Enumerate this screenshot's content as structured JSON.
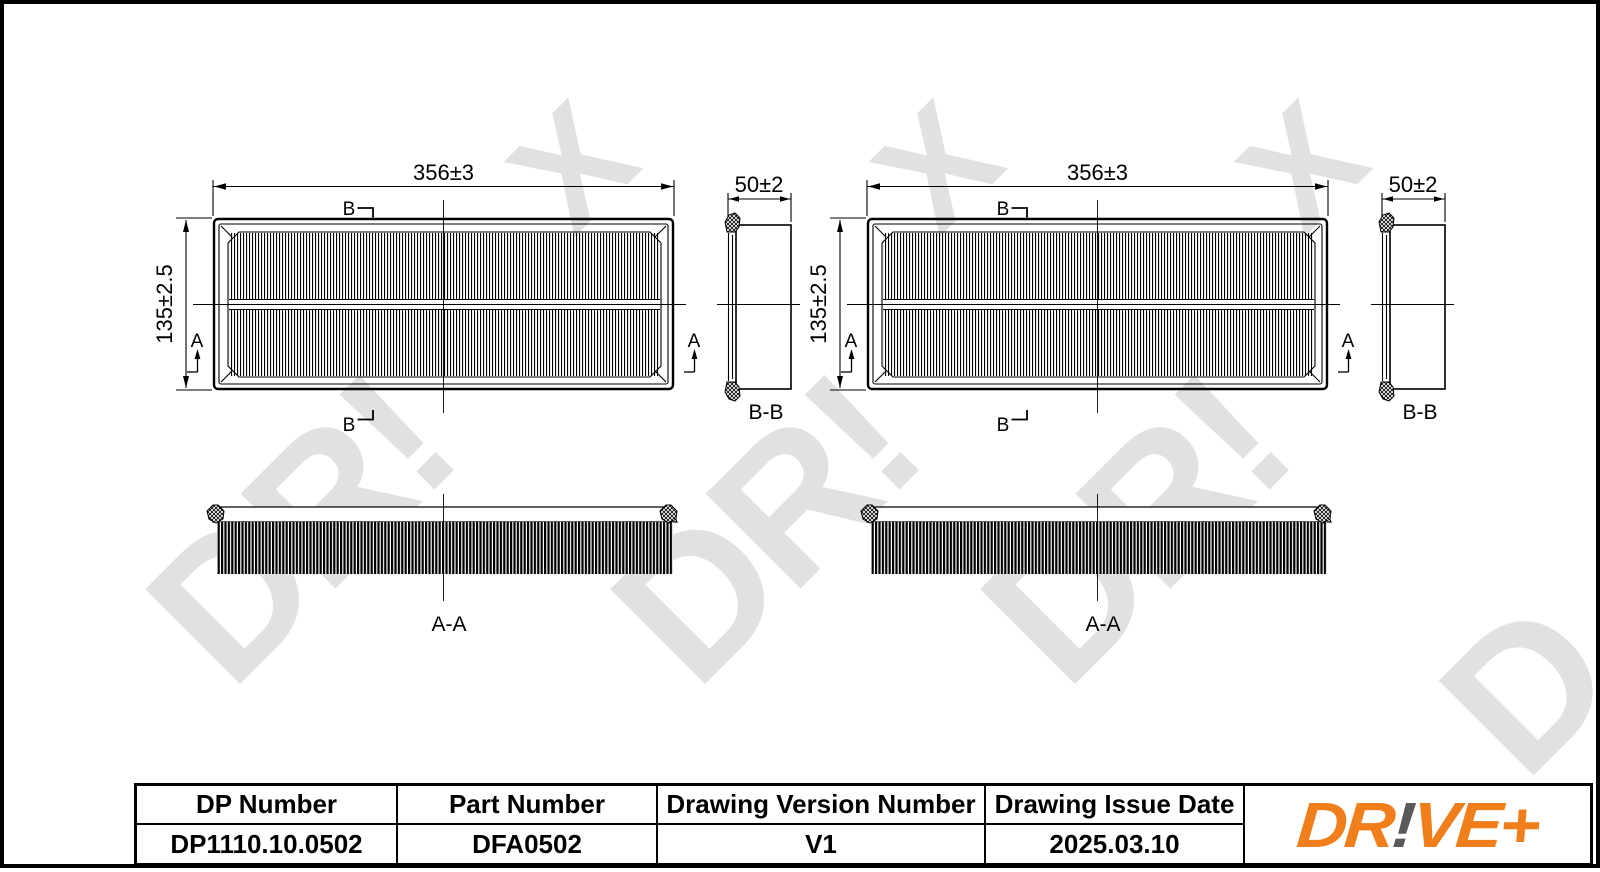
{
  "page": {
    "background": "#ffffff",
    "line_color": "#000000"
  },
  "watermark": {
    "color": "#e1e1e1",
    "fragments": [
      {
        "text": "X"
      },
      {
        "text": "X"
      },
      {
        "text": "X"
      },
      {
        "text": "DR!"
      },
      {
        "text": "DR!"
      },
      {
        "text": "DR!"
      },
      {
        "text": "D"
      }
    ]
  },
  "drawing": {
    "labels": {
      "width_dim": "356±3",
      "height_dim": "135±2.5",
      "depth_dim": "50±2",
      "section_b": "B",
      "section_a": "A",
      "section_bb": "B-B",
      "section_aa": "A-A"
    }
  },
  "title_block": {
    "columns": [
      {
        "header": "DP Number",
        "value": "DP1110.10.0502"
      },
      {
        "header": "Part Number",
        "value": "DFA0502"
      },
      {
        "header": "Drawing Version Number",
        "value": "V1"
      },
      {
        "header": "Drawing Issue Date",
        "value": "2025.03.10"
      }
    ],
    "logo": {
      "dr": "DR",
      "bang": "!",
      "ve": "VE",
      "plus": "+"
    }
  },
  "colors": {
    "logo_orange": "#F07E1B",
    "logo_gray": "#5A5A5C",
    "watermark_gray": "#e1e1e1"
  }
}
